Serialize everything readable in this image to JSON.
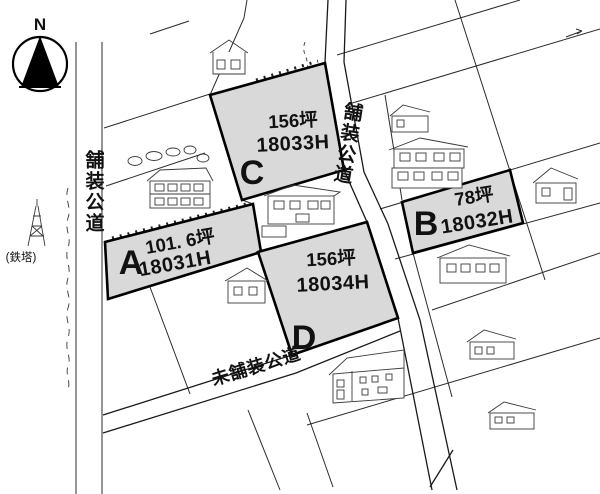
{
  "map": {
    "title": "residential land plat map",
    "compass": {
      "north_label": "N"
    },
    "landmark": {
      "tower_label": "(鉄塔)"
    },
    "roads": {
      "left_paved_label": "舗装公道",
      "right_paved_label": "舗装公道",
      "bottom_unpaved_label": "未舗装公道"
    },
    "parcels": [
      {
        "letter": "A",
        "area": "101. 6坪",
        "code": "18031H"
      },
      {
        "letter": "B",
        "area": "78坪",
        "code": "18032H"
      },
      {
        "letter": "C",
        "area": "156坪",
        "code": "18033H"
      },
      {
        "letter": "D",
        "area": "156坪",
        "code": "18034H"
      }
    ],
    "colors": {
      "parcel_fill": "#d9d9d9",
      "line": "#1a1a1a",
      "background": "#ffffff"
    }
  }
}
